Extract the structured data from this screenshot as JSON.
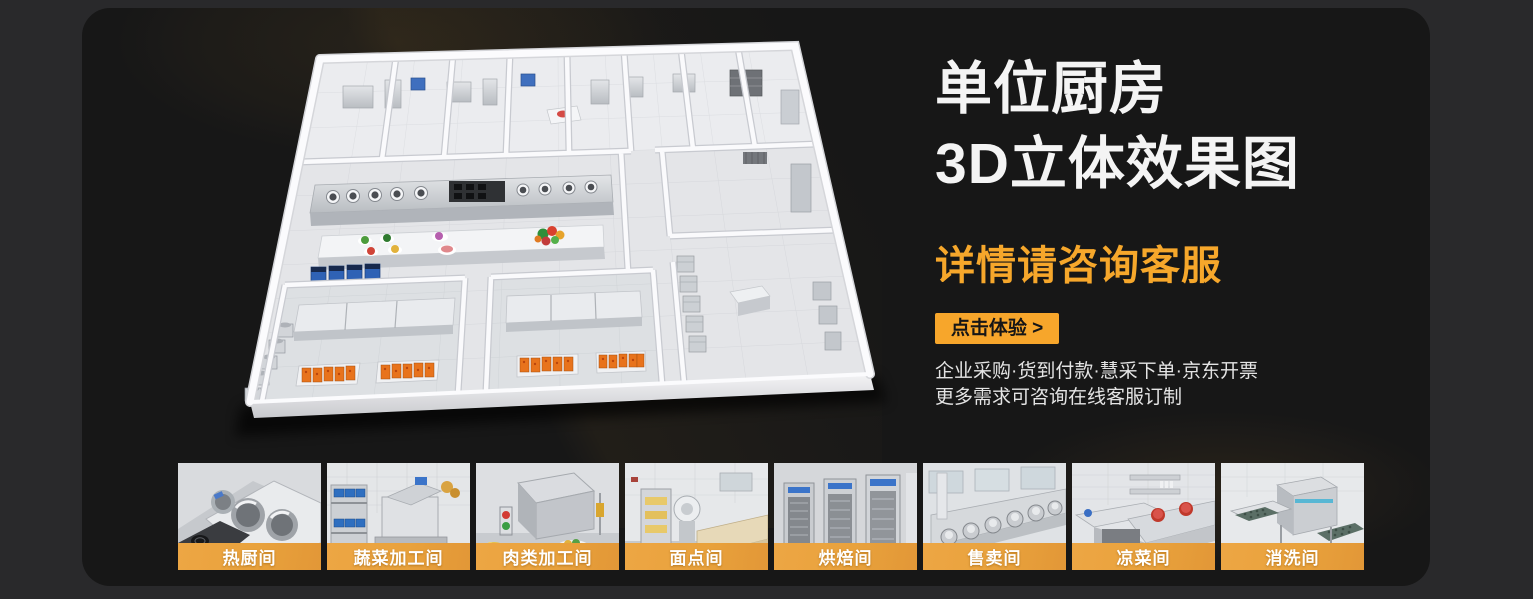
{
  "hero": {
    "title_line1": "单位厨房",
    "title_line2": "3D立体效果图",
    "subtitle": "详情请咨询客服",
    "cta_label": "点击体验 >",
    "note_line1": "企业采购·货到付款·慧采下单·京东开票",
    "note_line2": "更多需求可咨询在线客服订制",
    "accent_color": "#F6A72B",
    "title_color": "#F4F4F4"
  },
  "floorplan": {
    "description": "单位厨房3D立体效果图"
  },
  "gallery": {
    "items": [
      {
        "label": "热厨间"
      },
      {
        "label": "蔬菜加工间"
      },
      {
        "label": "肉类加工间"
      },
      {
        "label": "面点间"
      },
      {
        "label": "烘焙间"
      },
      {
        "label": "售卖间"
      },
      {
        "label": "凉菜间"
      },
      {
        "label": "消洗间"
      }
    ]
  }
}
